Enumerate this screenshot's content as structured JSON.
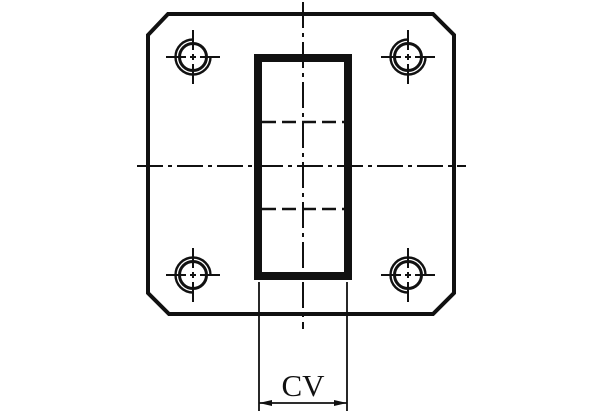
{
  "drawing": {
    "kind": "technical-drawing-front-view",
    "dimension_label": "CV",
    "colors": {
      "line": "#111111",
      "background": "#ffffff"
    }
  }
}
